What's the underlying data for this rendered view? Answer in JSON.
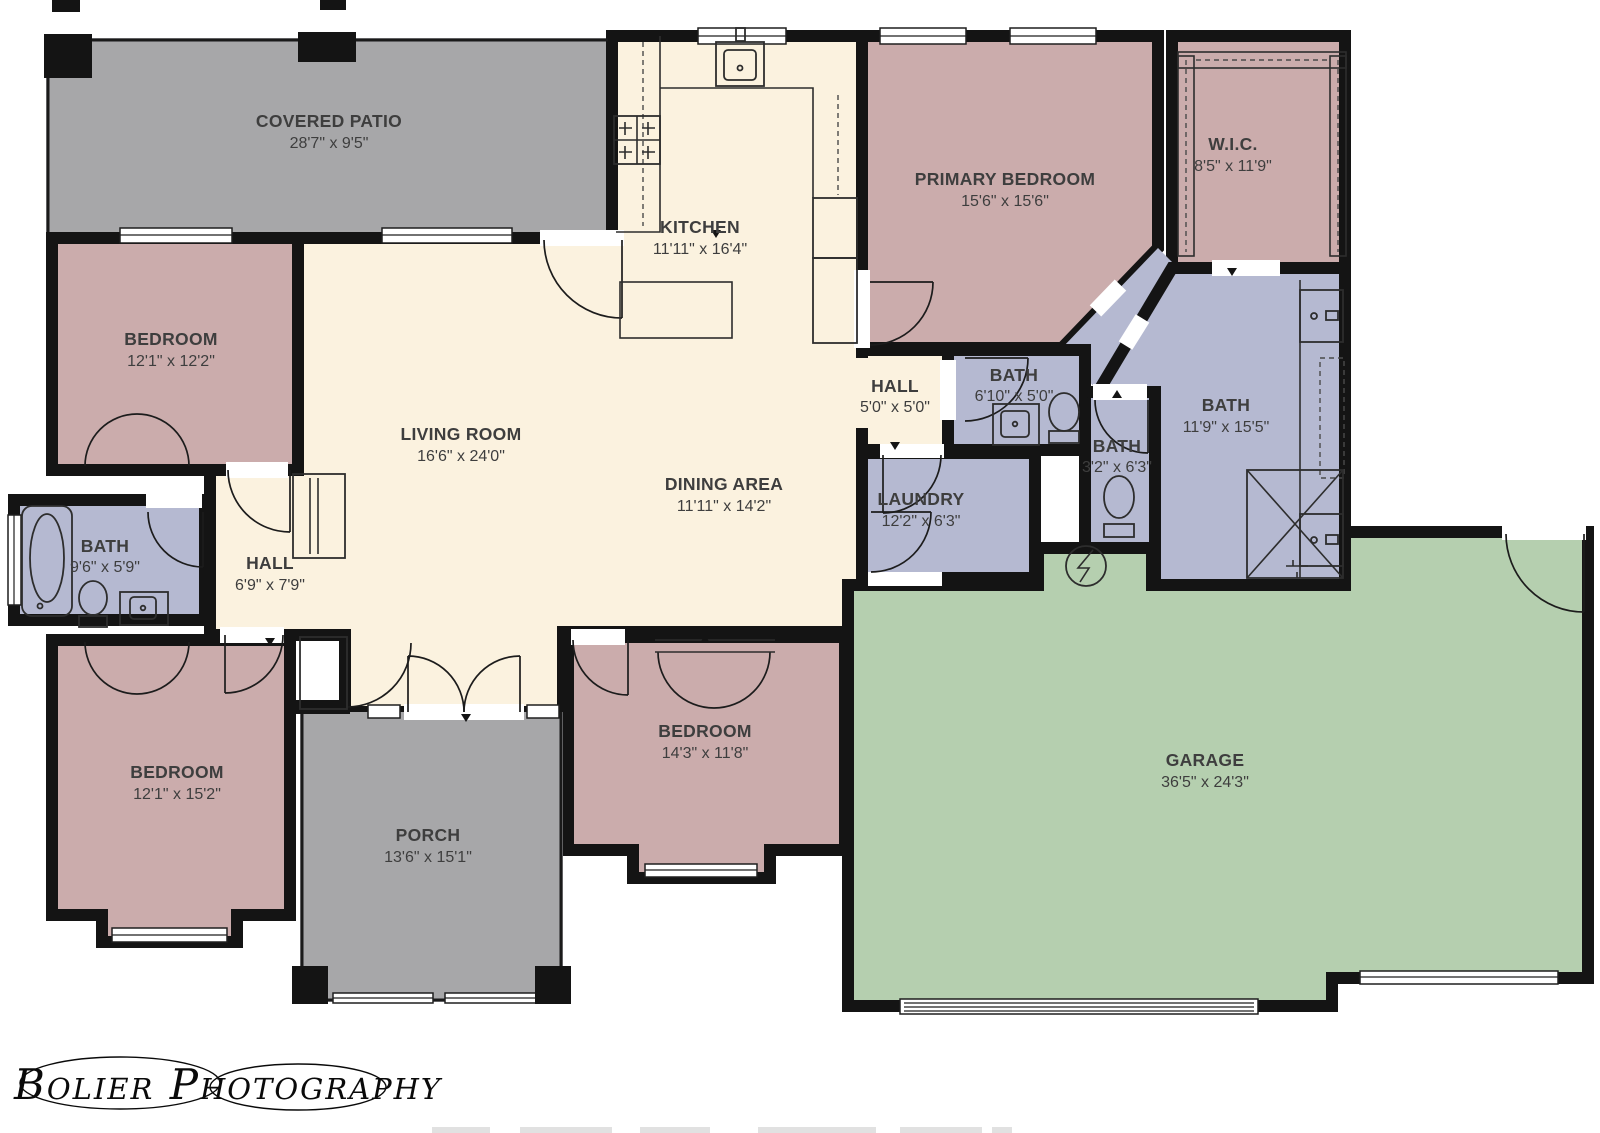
{
  "title": "Single-story house floor plan",
  "watermark": "Bolier Photography",
  "colors": {
    "wall": "#141414",
    "bedroom": "#cbacac",
    "living": "#fbf2df",
    "patio": "#a7a7a9",
    "bath": "#b5b9d1",
    "garage": "#b5cfaf",
    "label": "#3e3e3e",
    "white": "#ffffff"
  },
  "rooms": {
    "covered_patio": {
      "name": "COVERED PATIO",
      "dims": "28'7\" x 9'5\""
    },
    "bedroom_top_left": {
      "name": "BEDROOM",
      "dims": "12'1\" x 12'2\""
    },
    "kitchen": {
      "name": "KITCHEN",
      "dims": "11'11\" x 16'4\""
    },
    "primary_bedroom": {
      "name": "PRIMARY BEDROOM",
      "dims": "15'6\" x 15'6\""
    },
    "wic": {
      "name": "W.I.C.",
      "dims": "8'5\" x 11'9\""
    },
    "living_room": {
      "name": "LIVING ROOM",
      "dims": "16'6\" x 24'0\""
    },
    "dining_area": {
      "name": "DINING AREA",
      "dims": "11'11\" x 14'2\""
    },
    "hall_center": {
      "name": "HALL",
      "dims": "5'0\" x 5'0\""
    },
    "bath_hall": {
      "name": "BATH",
      "dims": "6'10\" x 5'0\""
    },
    "bath_primary": {
      "name": "BATH",
      "dims": "11'9\" x 15'5\""
    },
    "bath_small": {
      "name": "BATH",
      "dims": "3'2\" x 6'3\""
    },
    "laundry": {
      "name": "LAUNDRY",
      "dims": "12'2\" x 6'3\""
    },
    "hall_west": {
      "name": "HALL",
      "dims": "6'9\" x 7'9\""
    },
    "bath_west": {
      "name": "BATH",
      "dims": "9'6\" x 5'9\""
    },
    "bedroom_bottom_left": {
      "name": "BEDROOM",
      "dims": "12'1\" x 15'2\""
    },
    "porch": {
      "name": "PORCH",
      "dims": "13'6\" x 15'1\""
    },
    "bedroom_bottom_center": {
      "name": "BEDROOM",
      "dims": "14'3\" x 11'8\""
    },
    "garage": {
      "name": "GARAGE",
      "dims": "36'5\" x 24'3\""
    }
  }
}
